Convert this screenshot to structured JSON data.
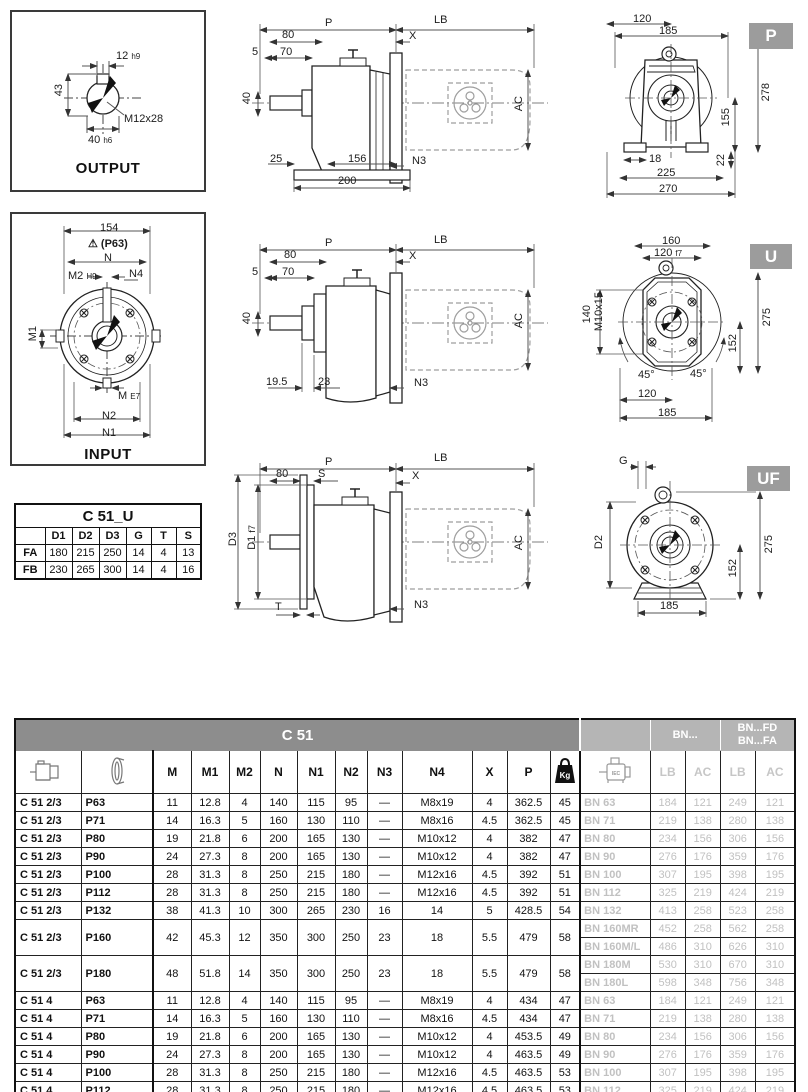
{
  "output_box": {
    "caption": "OUTPUT",
    "keyw": "12",
    "keyw_tol": "h9",
    "height": "43",
    "thread": "M12x28",
    "dia": "40",
    "dia_tol": "h6"
  },
  "input_box": {
    "caption": "INPUT",
    "w154": "154",
    "warn_icon": "warning-triangle-icon",
    "warn": "(P63)",
    "n": "N",
    "m2": "M2",
    "m2_tol": "H9",
    "n4": "N4",
    "m1": "M1",
    "m": "M",
    "m_tol": "E7",
    "n2": "N2",
    "n1": "N1"
  },
  "c51u_table": {
    "title": "C 51_U",
    "headers": [
      "D1",
      "D2",
      "D3",
      "G",
      "T",
      "S"
    ],
    "rows": [
      {
        "label": "FA",
        "values": [
          "180",
          "215",
          "250",
          "14",
          "4",
          "13"
        ]
      },
      {
        "label": "FB",
        "values": [
          "230",
          "265",
          "300",
          "14",
          "4",
          "16"
        ]
      }
    ]
  },
  "sv1": {
    "p": "P",
    "lb": "LB",
    "x": "X",
    "d80": "80",
    "d5": "5",
    "d70": "70",
    "d40": "40",
    "b25": "25",
    "b156": "156",
    "b200": "200",
    "n3": "N3",
    "ac": "AC"
  },
  "sv2": {
    "p": "P",
    "lb": "LB",
    "x": "X",
    "d80": "80",
    "d5": "5",
    "d70": "70",
    "d40": "40",
    "b195": "19.5",
    "b23": "23",
    "n3": "N3",
    "ac": "AC"
  },
  "sv3": {
    "p": "P",
    "lb": "LB",
    "d80": "80",
    "s": "S",
    "x": "X",
    "d3": "D3",
    "d1": "D1",
    "d1_tol": "f7",
    "t": "T",
    "n3": "N3",
    "ac": "AC"
  },
  "ev1": {
    "tab": "P",
    "d120": "120",
    "d185": "185",
    "d278": "278",
    "d155": "155",
    "d18": "18",
    "d225": "225",
    "d22": "22",
    "d270": "270"
  },
  "ev2": {
    "tab": "U",
    "d160": "160",
    "d120f7": "120",
    "d120f7_tol": "f7",
    "d140": "140",
    "m10": "M10x15",
    "d275": "275",
    "d152": "152",
    "a1": "45°",
    "a2": "45°",
    "d120": "120",
    "d185": "185"
  },
  "ev3": {
    "tab": "UF",
    "g": "G",
    "d2": "D2",
    "d275": "275",
    "d152": "152",
    "d185": "185"
  },
  "table": {
    "title": "C 51",
    "bn_header": "BN...",
    "bnfd_line1": "BN...FD",
    "bnfd_line2": "BN...FA",
    "col_headers": [
      "M",
      "M1",
      "M2",
      "N",
      "N1",
      "N2",
      "N3",
      "N4",
      "X",
      "P"
    ],
    "kg_label": "Kg",
    "motor_label": "IEC",
    "sub_headers": [
      "LB",
      "AC",
      "LB",
      "AC"
    ],
    "rows": [
      {
        "model": "C 51 2/3",
        "size": "P63",
        "vals": [
          "11",
          "12.8",
          "4",
          "140",
          "115",
          "95",
          "—",
          "M8x19",
          "4",
          "362.5",
          "45"
        ],
        "bn": [
          [
            "BN 63",
            "184",
            "121",
            "249",
            "121"
          ]
        ]
      },
      {
        "model": "C 51 2/3",
        "size": "P71",
        "vals": [
          "14",
          "16.3",
          "5",
          "160",
          "130",
          "110",
          "—",
          "M8x16",
          "4.5",
          "362.5",
          "45"
        ],
        "bn": [
          [
            "BN 71",
            "219",
            "138",
            "280",
            "138"
          ]
        ]
      },
      {
        "model": "C 51 2/3",
        "size": "P80",
        "vals": [
          "19",
          "21.8",
          "6",
          "200",
          "165",
          "130",
          "—",
          "M10x12",
          "4",
          "382",
          "47"
        ],
        "bn": [
          [
            "BN 80",
            "234",
            "156",
            "306",
            "156"
          ]
        ]
      },
      {
        "model": "C 51 2/3",
        "size": "P90",
        "vals": [
          "24",
          "27.3",
          "8",
          "200",
          "165",
          "130",
          "—",
          "M10x12",
          "4",
          "382",
          "47"
        ],
        "bn": [
          [
            "BN 90",
            "276",
            "176",
            "359",
            "176"
          ]
        ]
      },
      {
        "model": "C 51 2/3",
        "size": "P100",
        "vals": [
          "28",
          "31.3",
          "8",
          "250",
          "215",
          "180",
          "—",
          "M12x16",
          "4.5",
          "392",
          "51"
        ],
        "bn": [
          [
            "BN 100",
            "307",
            "195",
            "398",
            "195"
          ]
        ]
      },
      {
        "model": "C 51 2/3",
        "size": "P112",
        "vals": [
          "28",
          "31.3",
          "8",
          "250",
          "215",
          "180",
          "—",
          "M12x16",
          "4.5",
          "392",
          "51"
        ],
        "bn": [
          [
            "BN 112",
            "325",
            "219",
            "424",
            "219"
          ]
        ]
      },
      {
        "model": "C 51 2/3",
        "size": "P132",
        "vals": [
          "38",
          "41.3",
          "10",
          "300",
          "265",
          "230",
          "16",
          "14",
          "5",
          "428.5",
          "54"
        ],
        "bn": [
          [
            "BN 132",
            "413",
            "258",
            "523",
            "258"
          ]
        ]
      },
      {
        "model": "C 51 2/3",
        "size": "P160",
        "vals": [
          "42",
          "45.3",
          "12",
          "350",
          "300",
          "250",
          "23",
          "18",
          "5.5",
          "479",
          "58"
        ],
        "bn": [
          [
            "BN 160MR",
            "452",
            "258",
            "562",
            "258"
          ],
          [
            "BN 160M/L",
            "486",
            "310",
            "626",
            "310"
          ]
        ]
      },
      {
        "model": "C 51 2/3",
        "size": "P180",
        "vals": [
          "48",
          "51.8",
          "14",
          "350",
          "300",
          "250",
          "23",
          "18",
          "5.5",
          "479",
          "58"
        ],
        "bn": [
          [
            "BN 180M",
            "530",
            "310",
            "670",
            "310"
          ],
          [
            "BN 180L",
            "598",
            "348",
            "756",
            "348"
          ]
        ]
      },
      {
        "model": "C 51 4",
        "size": "P63",
        "vals": [
          "11",
          "12.8",
          "4",
          "140",
          "115",
          "95",
          "—",
          "M8x19",
          "4",
          "434",
          "47"
        ],
        "bn": [
          [
            "BN 63",
            "184",
            "121",
            "249",
            "121"
          ]
        ]
      },
      {
        "model": "C 51 4",
        "size": "P71",
        "vals": [
          "14",
          "16.3",
          "5",
          "160",
          "130",
          "110",
          "—",
          "M8x16",
          "4.5",
          "434",
          "47"
        ],
        "bn": [
          [
            "BN 71",
            "219",
            "138",
            "280",
            "138"
          ]
        ]
      },
      {
        "model": "C 51 4",
        "size": "P80",
        "vals": [
          "19",
          "21.8",
          "6",
          "200",
          "165",
          "130",
          "—",
          "M10x12",
          "4",
          "453.5",
          "49"
        ],
        "bn": [
          [
            "BN 80",
            "234",
            "156",
            "306",
            "156"
          ]
        ]
      },
      {
        "model": "C 51 4",
        "size": "P90",
        "vals": [
          "24",
          "27.3",
          "8",
          "200",
          "165",
          "130",
          "—",
          "M10x12",
          "4",
          "463.5",
          "49"
        ],
        "bn": [
          [
            "BN 90",
            "276",
            "176",
            "359",
            "176"
          ]
        ]
      },
      {
        "model": "C 51 4",
        "size": "P100",
        "vals": [
          "28",
          "31.3",
          "8",
          "250",
          "215",
          "180",
          "—",
          "M12x16",
          "4.5",
          "463.5",
          "53"
        ],
        "bn": [
          [
            "BN 100",
            "307",
            "195",
            "398",
            "195"
          ]
        ]
      },
      {
        "model": "C 51 4",
        "size": "P112",
        "vals": [
          "28",
          "31.3",
          "8",
          "250",
          "215",
          "180",
          "—",
          "M12x16",
          "4.5",
          "463.5",
          "53"
        ],
        "bn": [
          [
            "BN 112",
            "325",
            "219",
            "424",
            "219"
          ]
        ]
      }
    ]
  }
}
